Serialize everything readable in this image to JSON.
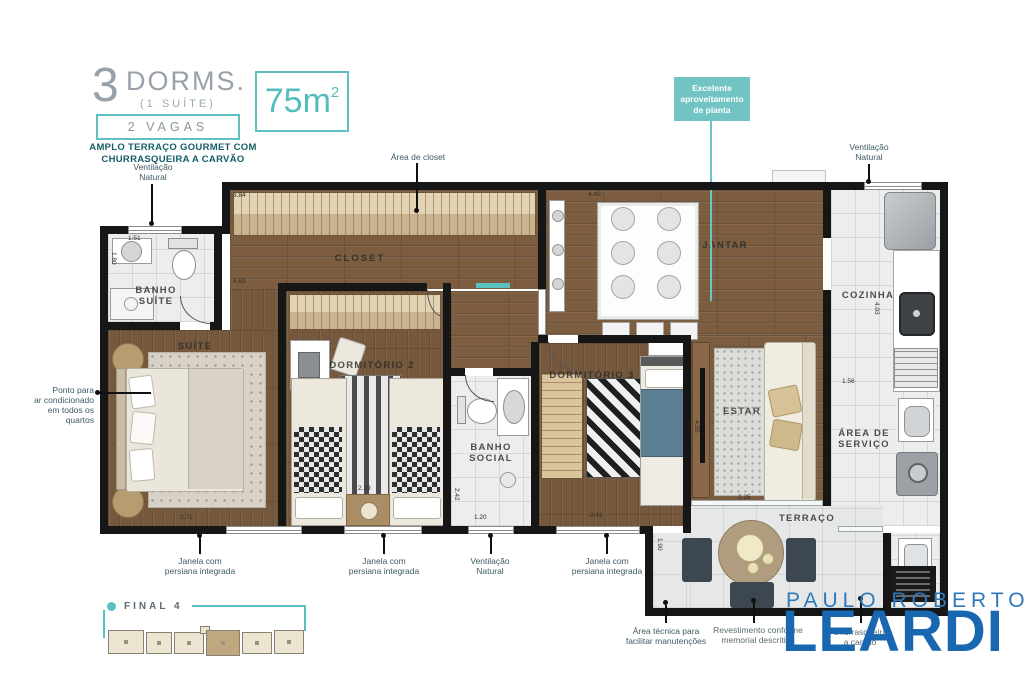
{
  "header": {
    "dorms_number": "3",
    "dorms_label": "DORMS.",
    "dorms_sub": "(1 SUÍTE)",
    "vagas": "2 VAGAS",
    "feature": "AMPLO TERRAÇO GOURMET COM\nCHURRASQUEIRA A CARVÃO",
    "area_value": "75m",
    "area_sup": "2"
  },
  "callout": {
    "text": "Excelente\naproveitamento\nde planta"
  },
  "rooms": {
    "banho_suite": "BANHO\nSUÍTE",
    "suite": "SUÍTE",
    "closet": "CLOSET",
    "dormitorio2": "DORMITÓRIO 2",
    "banho_social": "BANHO\nSOCIAL",
    "dormitorio3": "DORMITÓRIO 3",
    "jantar": "JANTAR",
    "estar": "ESTAR",
    "cozinha": "COZINHA",
    "area_servico": "ÁREA DE\nSERVIÇO",
    "terraco": "TERRAÇO"
  },
  "annotations": {
    "ventilacao": "Ventilação\nNatural",
    "area_closet": "Área de closet",
    "ponto_ar": "Ponto para\nar condicionado\nem todos os\nquartos",
    "janela": "Janela com\npersiana integrada",
    "area_tecnica": "Área técnica para\nfacilitar manutenções",
    "nota_revestimento": "Revestimento conforme\nmemorial descritivo",
    "nota_churrasqueira": "Churrasqueira\na carvão"
  },
  "dimensions": {
    "banho_top": "1.51",
    "banho_left": "1.80",
    "suite_bottom": "2.71",
    "closet_top": "3.84",
    "closet_bottom": "4.63",
    "jantar_top": "4.40",
    "dorm2_bottom": "2.19",
    "banho_social_bottom": "1.20",
    "banho_social_left": "2.42",
    "dorm3_bottom": "2.41",
    "cozinha_left": "4.03",
    "servico_top": "1.56",
    "estar_left": "4.55",
    "terraco_left": "1.90",
    "terraco_top": "2.25"
  },
  "keyplan": {
    "label": "FINAL 4"
  },
  "logo": {
    "line1": "PAULO ROBERTO",
    "line2": "LEARDI"
  },
  "colors": {
    "accent_teal": "#5ec1c2",
    "callout_teal": "#72c3c3",
    "logo_blue": "#1867b0",
    "logo_blue_light": "#2e79bc",
    "wall": "#161616",
    "wood": "#7c5d40",
    "tile": "#eceeee",
    "header_gray": "#98a1a9",
    "feature_teal": "#145d66"
  }
}
